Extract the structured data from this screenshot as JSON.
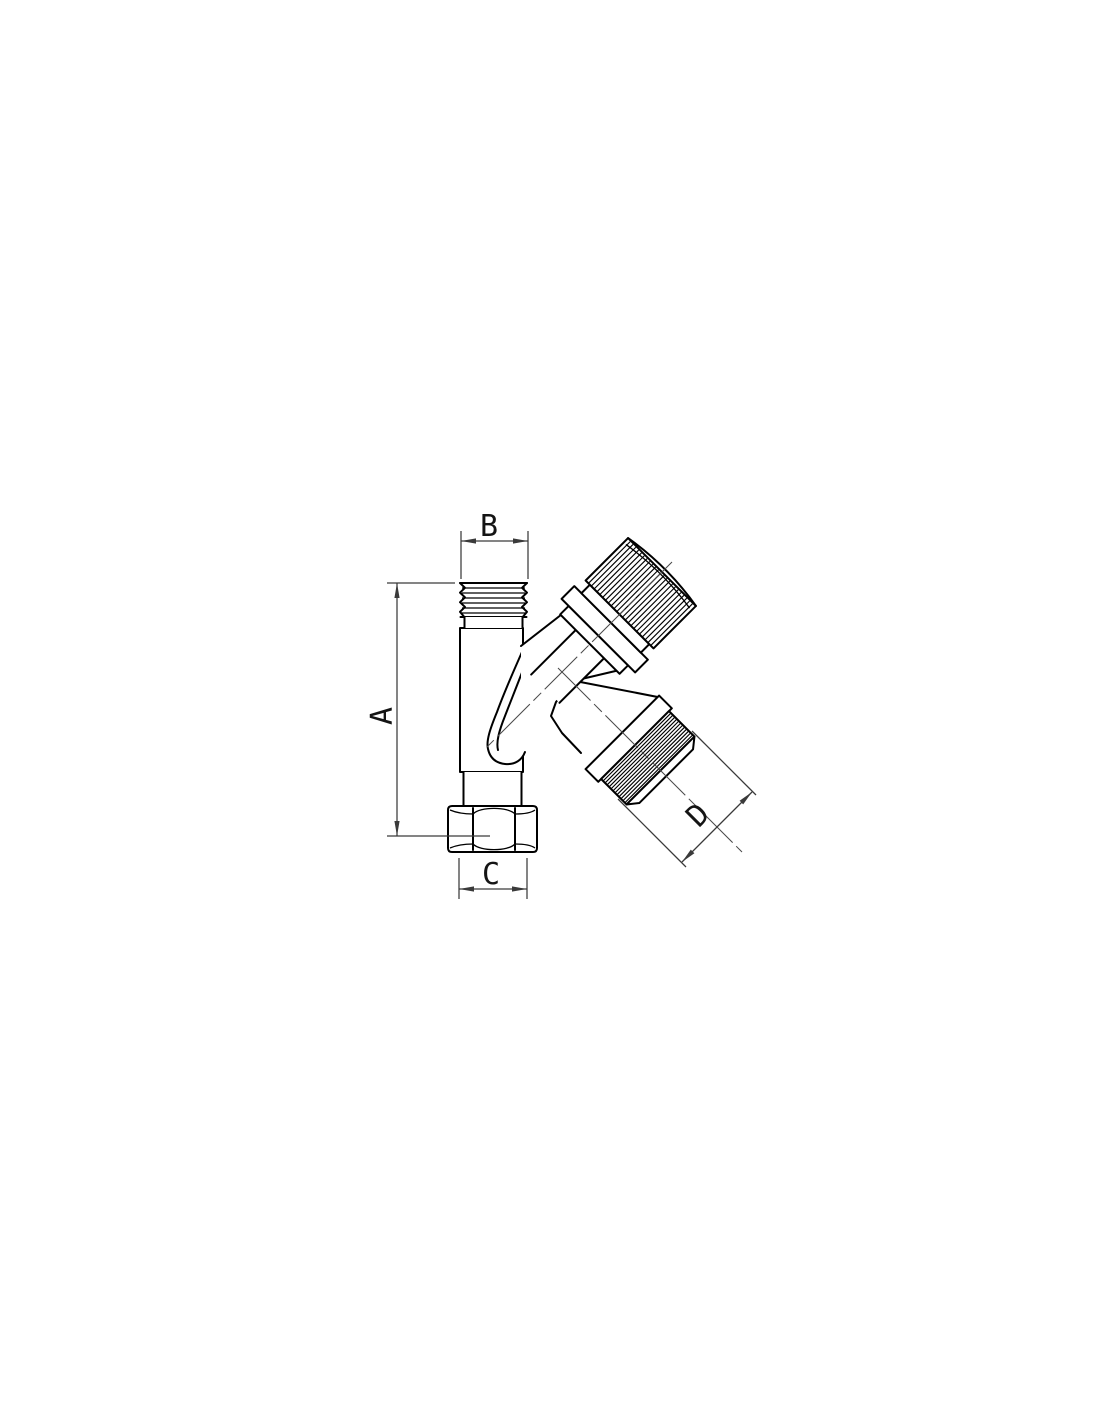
{
  "diagram": {
    "kind": "technical line drawing of an angle valve (front orthographic view)",
    "labels": {
      "a": "A",
      "b": "B",
      "c": "C",
      "d": "D"
    },
    "colors": {
      "background": "#ffffff",
      "outline": "#000000",
      "dimension": "#3a3a3a",
      "centerline": "#4a4a4a"
    }
  }
}
